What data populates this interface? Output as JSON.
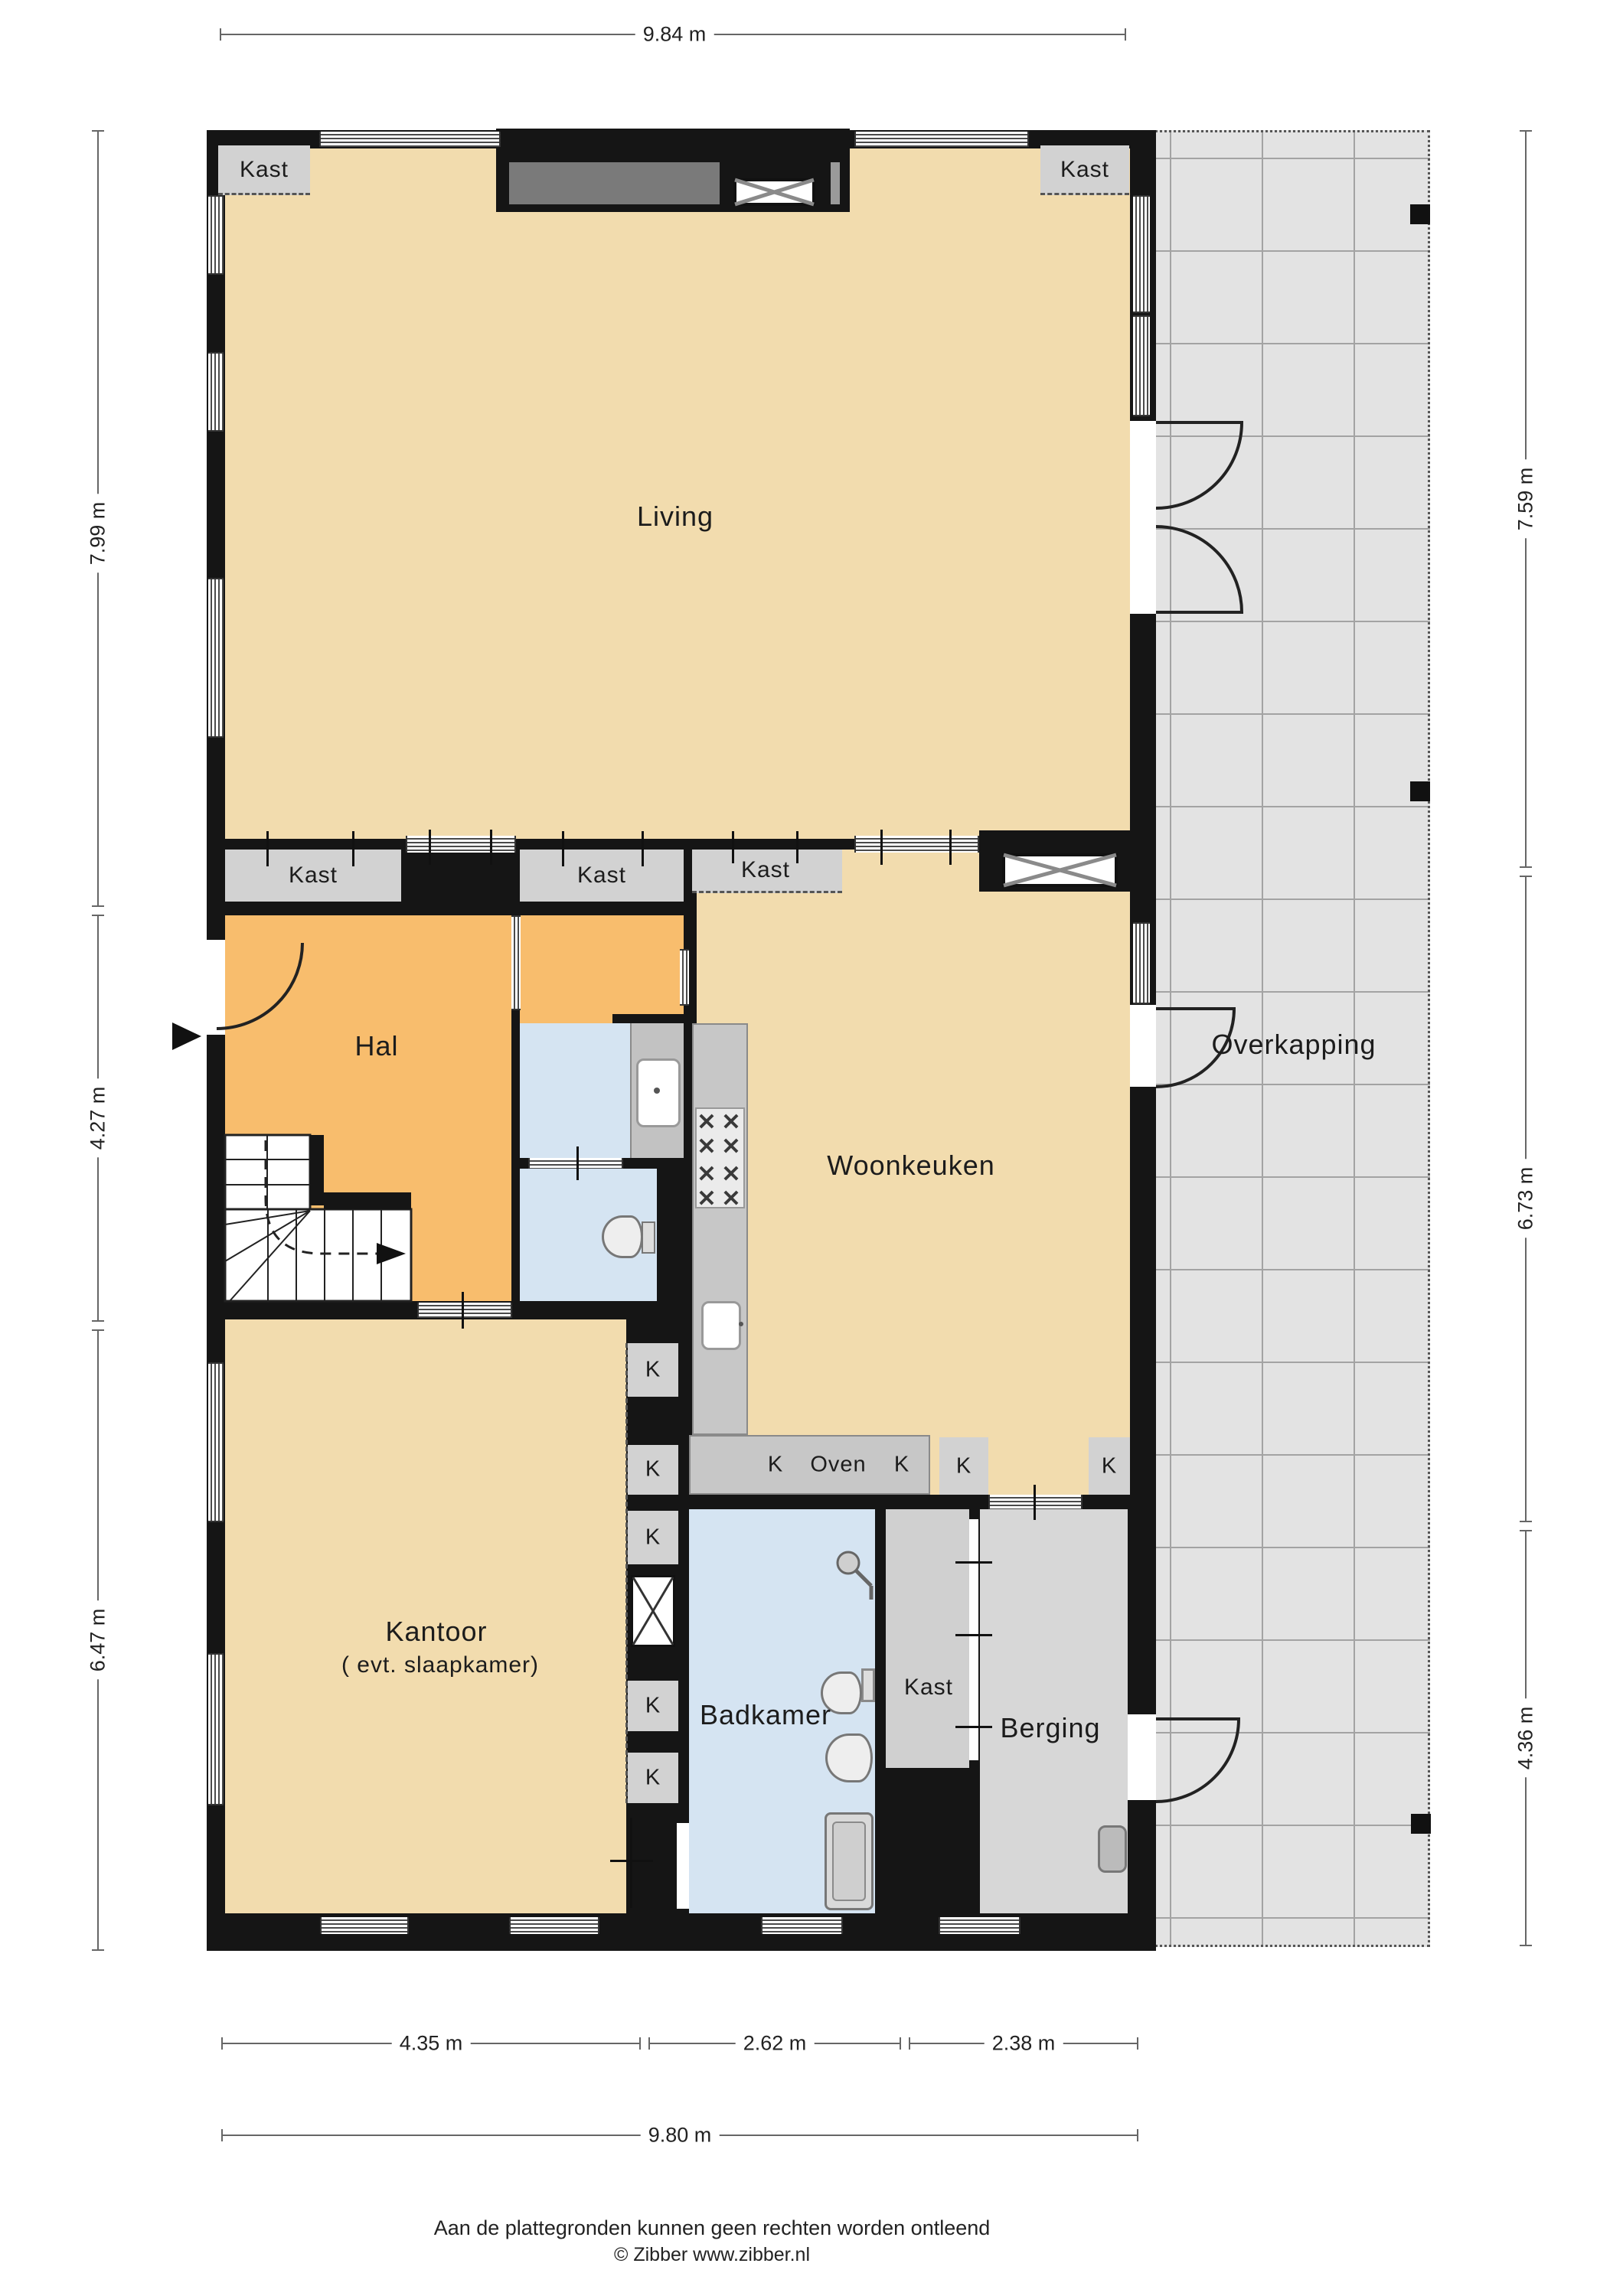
{
  "title": "Begane grond plattegrond",
  "rooms": {
    "living": {
      "label": "Living"
    },
    "hal": {
      "label": "Hal"
    },
    "woonkeuken": {
      "label": "Woonkeuken"
    },
    "kantoor": {
      "label": "Kantoor",
      "sublabel": "( evt. slaapkamer)"
    },
    "badkamer": {
      "label": "Badkamer"
    },
    "berging": {
      "label": "Berging"
    },
    "overkapping": {
      "label": "Overkapping"
    }
  },
  "closets": {
    "kast": "Kast",
    "k": "K",
    "oven": "Oven"
  },
  "dimensions": {
    "top_width": "9.84 m",
    "left": [
      "7.99 m",
      "4.27 m",
      "6.47 m"
    ],
    "right": [
      "7.59 m",
      "6.73 m",
      "4.36 m"
    ],
    "bottom_segments": [
      "4.35 m",
      "2.62 m",
      "2.38 m"
    ],
    "bottom_total": "9.80 m"
  },
  "footer": {
    "disclaimer": "Aan de plattegronden kunnen geen rechten worden ontleend",
    "credit": "© Zibber www.zibber.nl"
  },
  "colors": {
    "wall": "#151515",
    "floor_beige": "#f2dcae",
    "floor_orange": "#f8bd6d",
    "floor_blue": "#d5e4f2",
    "floor_gray_berging": "#d7d7d7",
    "closet_gray": "#d2d2d2",
    "counter_gray": "#c7c7c7",
    "overkapping_bg": "#e3e3e3",
    "grid_line": "#a3a3a3"
  }
}
